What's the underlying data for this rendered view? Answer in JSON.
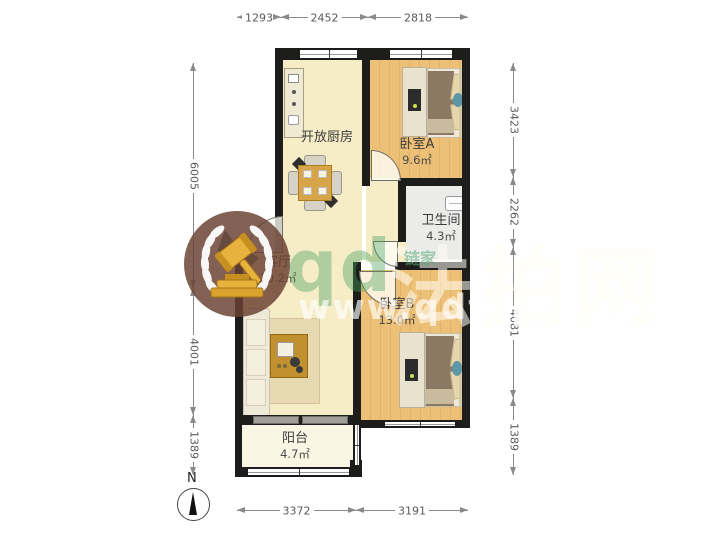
{
  "rooms": {
    "kitchen": {
      "name": "开放厨房",
      "area": ""
    },
    "bedroom_a": {
      "name": "卧室A",
      "area": "9.6㎡"
    },
    "bathroom": {
      "name": "卫生间",
      "area": "4.3㎡"
    },
    "living": {
      "name": "客厅",
      "area": "30.2㎡"
    },
    "bedroom_b": {
      "name": "卧室B",
      "area": "13.0㎡"
    },
    "balcony": {
      "name": "阳台",
      "area": "4.7㎡"
    }
  },
  "dimensions": {
    "top": [
      "1293",
      "2452",
      "2818"
    ],
    "bottom": [
      "3372",
      "3191"
    ],
    "left": [
      "6005",
      "4001",
      "1389"
    ],
    "right": [
      "3423",
      "2262",
      "4081",
      "1389"
    ]
  },
  "compass": {
    "north_label": "N"
  },
  "watermark": {
    "brand_latin": "qd",
    "brand_cn": "法拍网",
    "url": "www.qdfapai.com",
    "agency_mark": "链家"
  },
  "colors": {
    "wall": "#1d1d1b",
    "wood_floor": "#edc077",
    "warm_floor": "#f6ecc6",
    "gold": "#e7b23d",
    "watermark_green": "rgba(72,163,96,0.42)"
  }
}
